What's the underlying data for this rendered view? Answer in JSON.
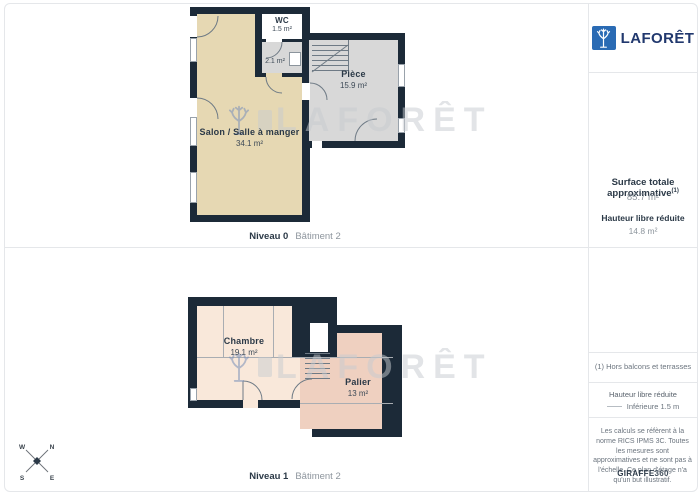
{
  "brand": {
    "name": "LAFORÊT"
  },
  "watermark": {
    "text": "LAFORÊT"
  },
  "plans": [
    {
      "level_label": "Niveau 0",
      "building_label": "Bâtiment 2",
      "rooms": [
        {
          "name": "WC",
          "area": "1.5 m²"
        },
        {
          "name": "",
          "area": "2.1 m²"
        },
        {
          "name": "Pièce",
          "area": "15.9 m²"
        },
        {
          "name": "Salon / Salle à manger",
          "area": "34.1 m²"
        }
      ]
    },
    {
      "level_label": "Niveau 1",
      "building_label": "Bâtiment 2",
      "rooms": [
        {
          "name": "Chambre",
          "area": "19.1 m²"
        },
        {
          "name": "Palier",
          "area": "13 m²"
        }
      ]
    }
  ],
  "sidebar": {
    "surface_title": "Surface totale approximative",
    "surface_superscript": "(1)",
    "surface_value": "85.7 m²",
    "reduced_height_title": "Hauteur libre réduite",
    "reduced_height_value": "14.8 m²",
    "footnote": "(1) Hors balcons et terrasses",
    "legend_title": "Hauteur libre réduite",
    "legend_item": "Inférieure 1.5 m",
    "disclaimer": "Les calculs se réfèrent à la norme RICS IPMS 3C. Toutes les mesures sont approximatives et ne sont pas à l'échelle. Ce plan d'étage n'a qu'un but illustratif.",
    "credit_brand": "GIRAFFE",
    "credit_suffix": "360"
  },
  "compass": {
    "n": "N",
    "e": "E",
    "s": "S",
    "w": "W"
  },
  "colors": {
    "wall": "#1c2a38",
    "salon": "#e6d8b3",
    "roomgray": "#d8d8d8",
    "chambre": "#f9e8da",
    "palier": "#efd0c0",
    "divider": "#e5e7ea",
    "navytext": "#2b3947",
    "graytext": "#8d959d",
    "muted": "#6b747e",
    "brandblue": "#2a6bb4",
    "brandnavy": "#21386e"
  }
}
